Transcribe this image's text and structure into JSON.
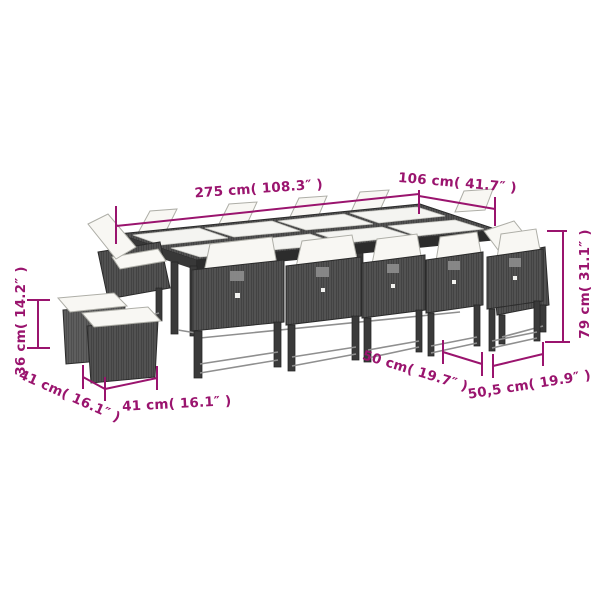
{
  "diagram": {
    "kind": "product-dimension-diagram",
    "subject": "poly rattan garden dining set: long glass-top table, dining chairs with white cushions and two cube stools",
    "accent_color": "#9a146e",
    "labels": {
      "table_length": "275 cm( 108.3″ )",
      "table_width": "106 cm( 41.7″ )",
      "chair_height": "79 cm( 31.1″ )",
      "stool_height": "36 cm( 14.2″ )",
      "stool_depth": "41 cm( 16.1″ )",
      "stool_width": "41 cm( 16.1″ )",
      "chair_depth": "50 cm( 19.7″ )",
      "chair_width": "50,5 cm( 19.9″ )"
    }
  }
}
